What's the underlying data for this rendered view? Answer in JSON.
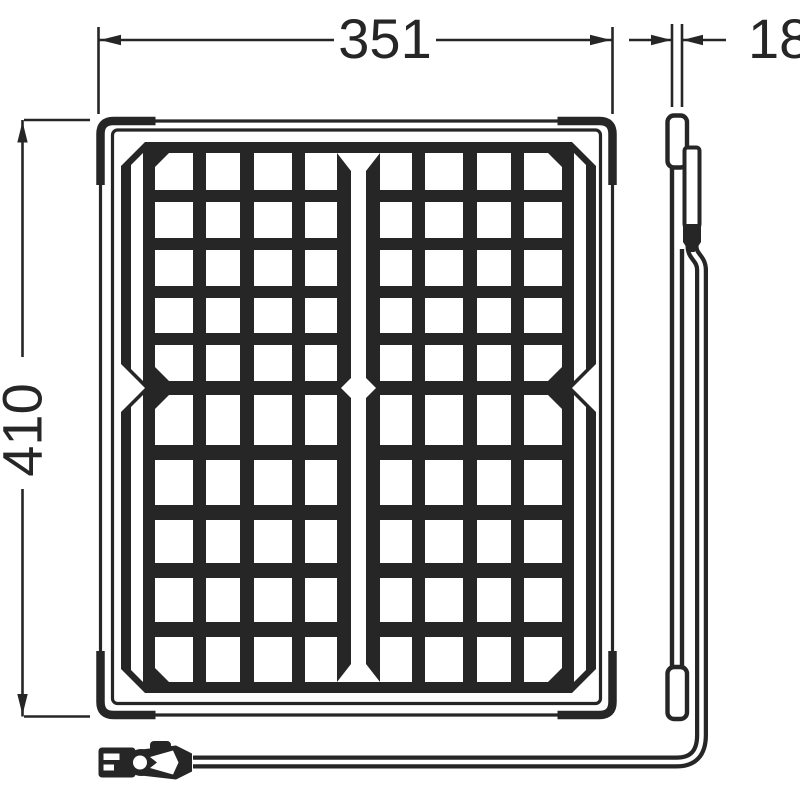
{
  "drawing": {
    "line_color": "#262626",
    "background_color": "#ffffff",
    "dimensions": {
      "width": {
        "label": "351",
        "position": "top"
      },
      "depth": {
        "label": "18",
        "position": "top-right"
      },
      "height": {
        "label": "410",
        "position": "left",
        "rotated": true
      }
    },
    "front_view": {
      "description": "framed solar panel front view",
      "cell_rows": 10,
      "cell_columns_per_half": 4,
      "narrow_edge_columns": 2,
      "corner_brackets": 4,
      "center_mark": "diamond"
    },
    "side_view": {
      "description": "thin panel profile with junction box and cable gland"
    },
    "cable": {
      "description": "cable running from junction box to clip connector at bottom left"
    }
  }
}
